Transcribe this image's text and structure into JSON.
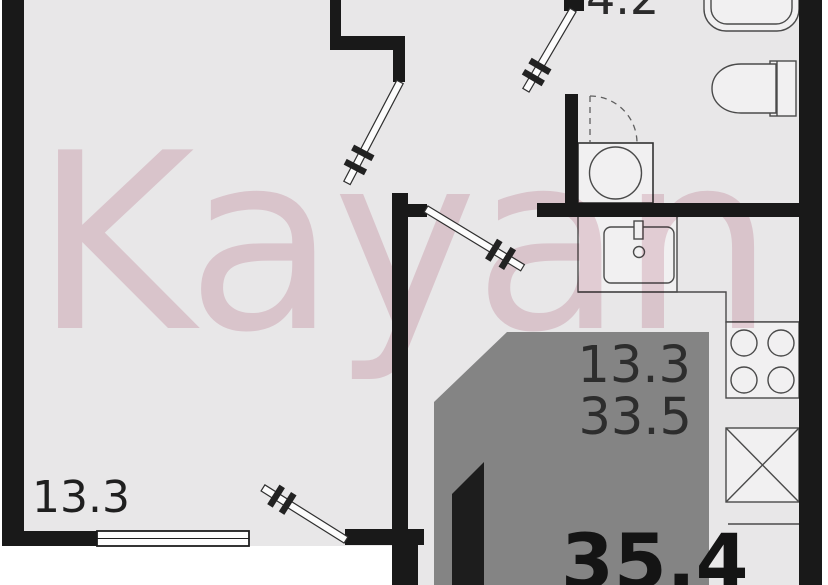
{
  "watermark": {
    "text": "Kayan",
    "color": "#d9a3b5"
  },
  "labels": {
    "hall_area": "4.2",
    "living_area": "13.3",
    "card_living_area": "13.3",
    "card_total_area": "33.5",
    "card_big_area": "35.4"
  },
  "colors": {
    "wall": "#191919",
    "floor": "#e8e7e8",
    "fixture_fill": "#f1f0f1",
    "fixture_line": "#4a4a4a",
    "highlight_fill": "#848484",
    "highlight_section": "#1d1d1d",
    "label_text": "#2b2b2b",
    "big_label_text": "#141414",
    "watermark_pink": "#d9a3b5"
  }
}
